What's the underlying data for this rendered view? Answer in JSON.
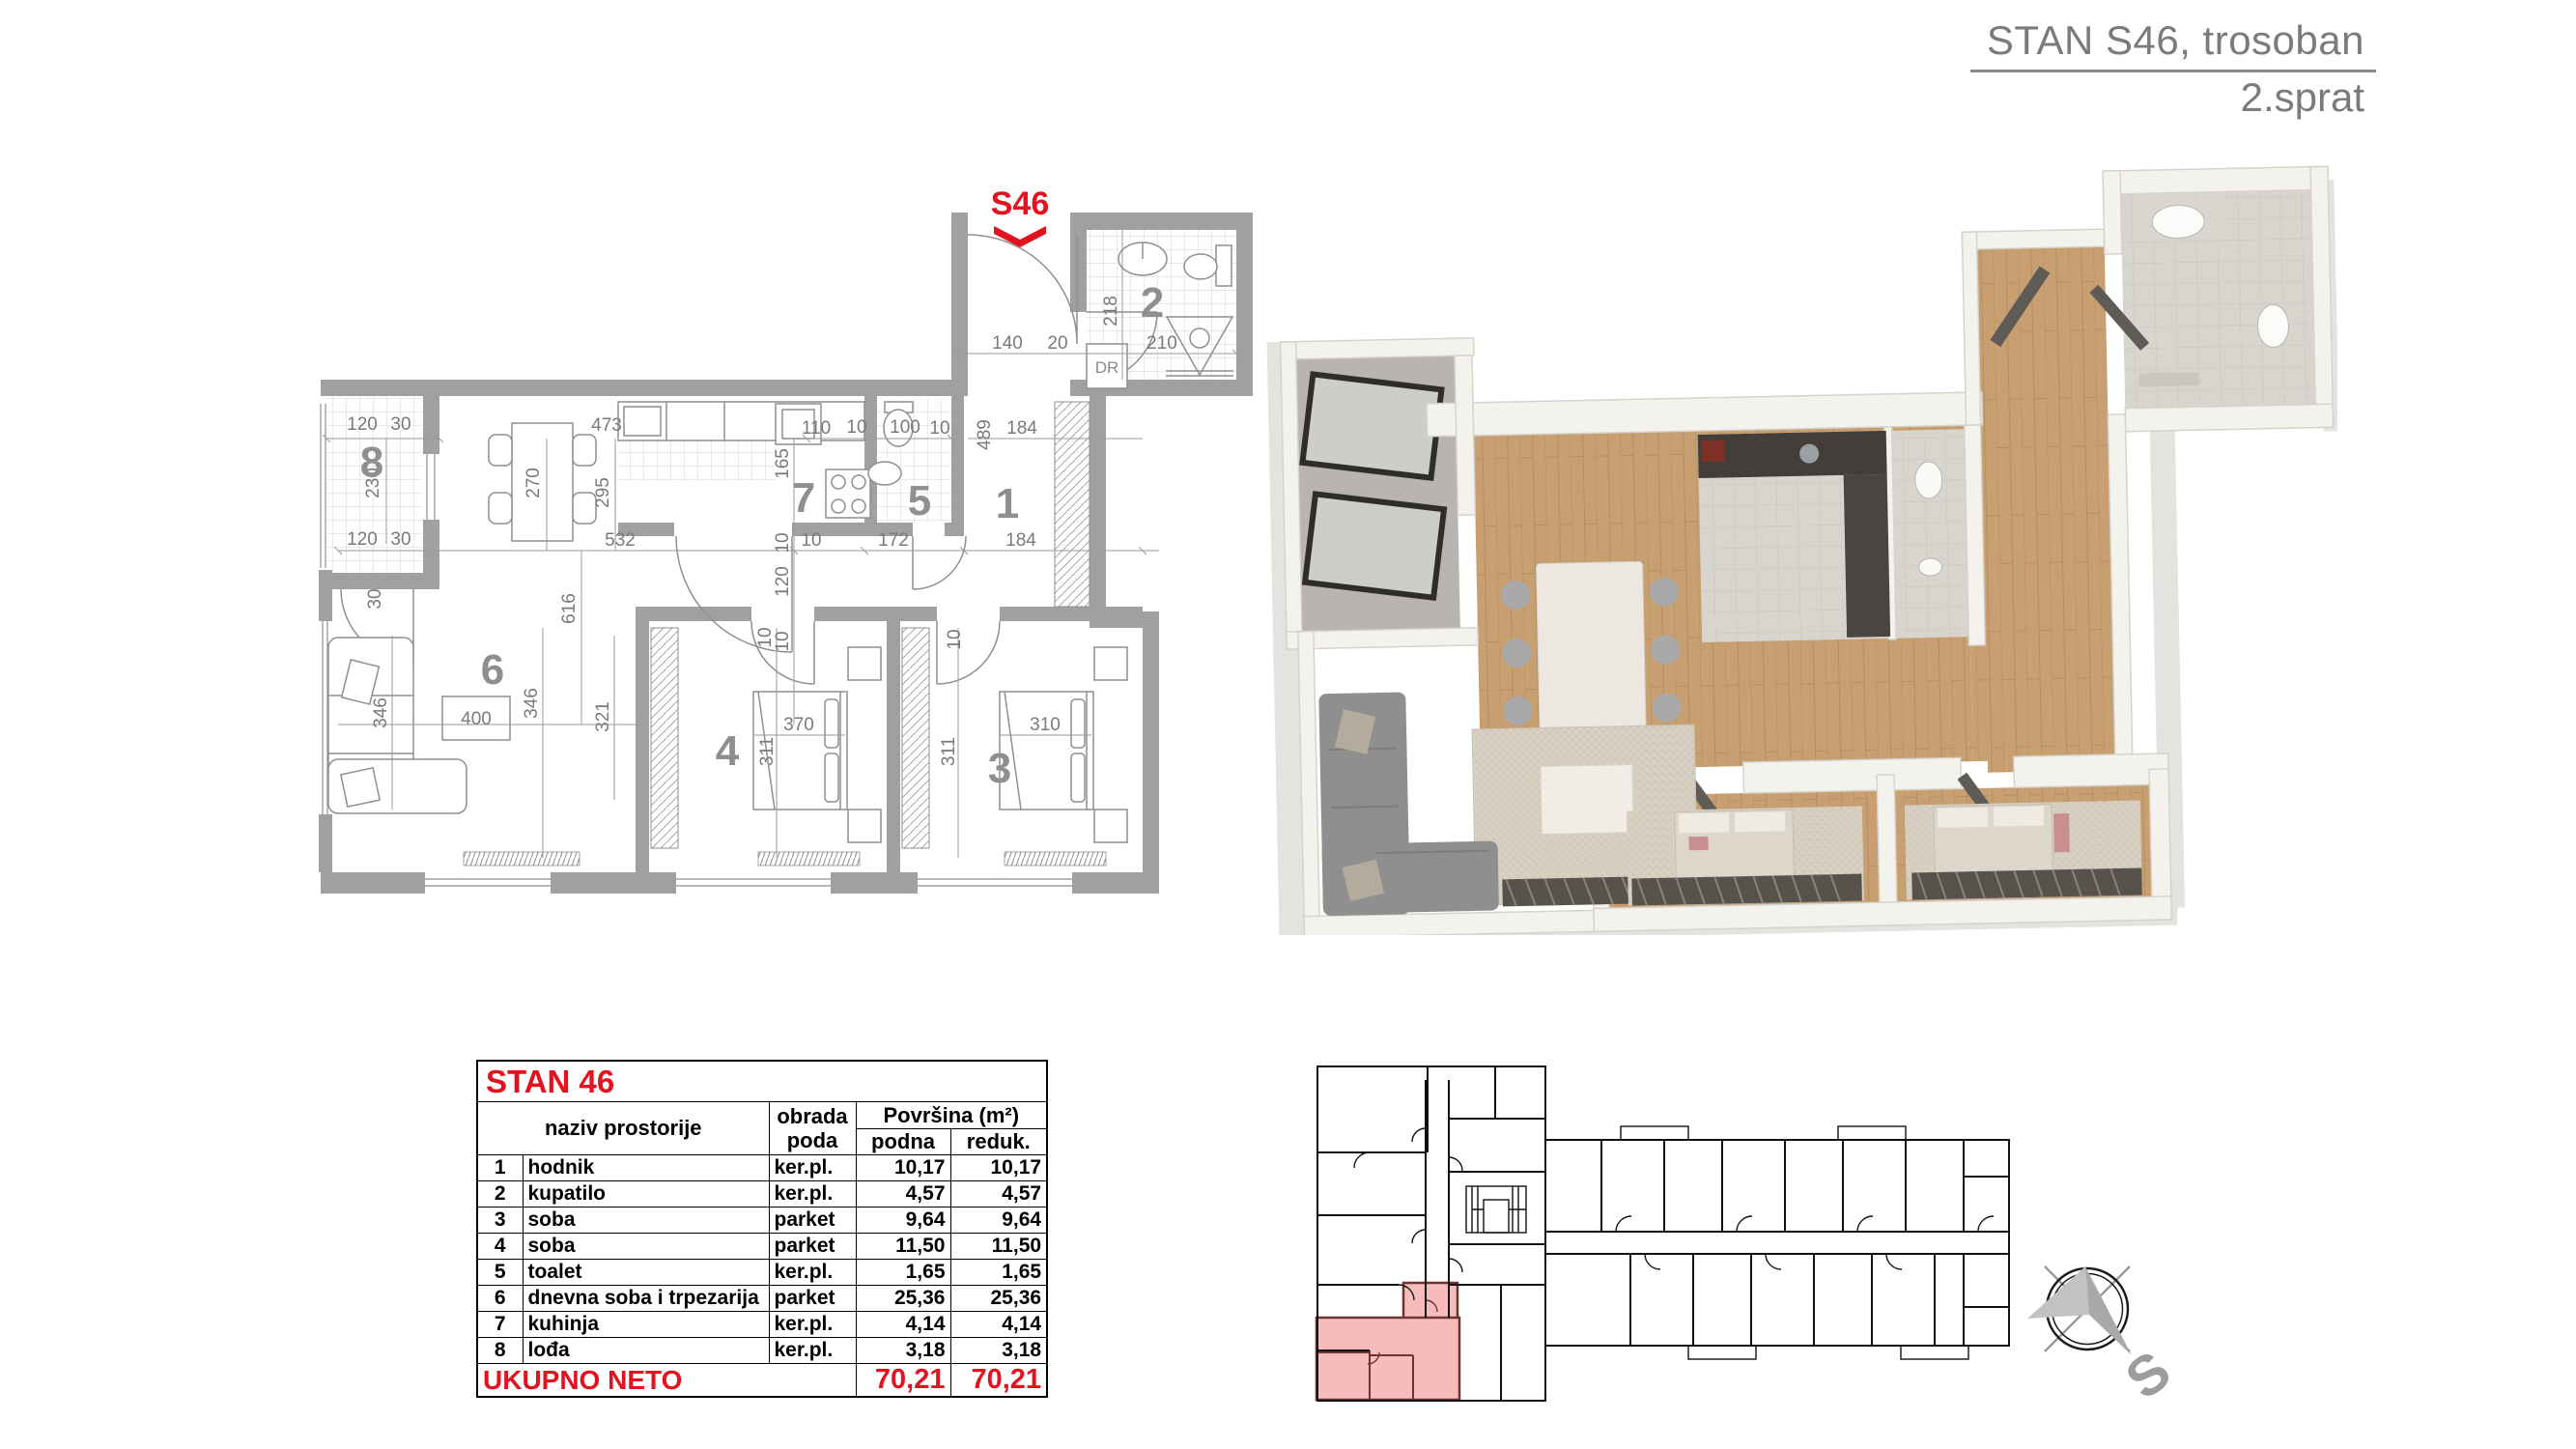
{
  "header": {
    "title": "STAN S46, trosoban",
    "floor": "2.sprat"
  },
  "plan2d": {
    "unit_label": "S46",
    "closet_label": "DR",
    "rooms": [
      "1",
      "2",
      "3",
      "4",
      "5",
      "6",
      "7",
      "8"
    ],
    "dims": [
      "120",
      "30",
      "230",
      "120",
      "30",
      "30",
      "473",
      "270",
      "295",
      "532",
      "616",
      "346",
      "346",
      "400",
      "321",
      "110",
      "10",
      "100",
      "10",
      "165",
      "10",
      "10",
      "172",
      "120",
      "10",
      "489",
      "184",
      "184",
      "140",
      "20",
      "218",
      "210",
      "370",
      "311",
      "310",
      "311",
      "10",
      "10"
    ]
  },
  "table": {
    "title": "STAN 46",
    "col_naziv": "naziv prostorije",
    "col_obrada_1": "obrada",
    "col_obrada_2": "poda",
    "col_povrsina": "Površina (m²)",
    "col_podna": "podna",
    "col_reduk": "reduk.",
    "rows": [
      {
        "num": "1",
        "name": "hodnik",
        "floor": "ker.pl.",
        "podna": "10,17",
        "reduk": "10,17"
      },
      {
        "num": "2",
        "name": "kupatilo",
        "floor": "ker.pl.",
        "podna": "4,57",
        "reduk": "4,57"
      },
      {
        "num": "3",
        "name": "soba",
        "floor": "parket",
        "podna": "9,64",
        "reduk": "9,64"
      },
      {
        "num": "4",
        "name": "soba",
        "floor": "parket",
        "podna": "11,50",
        "reduk": "11,50"
      },
      {
        "num": "5",
        "name": "toalet",
        "floor": "ker.pl.",
        "podna": "1,65",
        "reduk": "1,65"
      },
      {
        "num": "6",
        "name": "dnevna soba i trpezarija",
        "floor": "parket",
        "podna": "25,36",
        "reduk": "25,36"
      },
      {
        "num": "7",
        "name": "kuhinja",
        "floor": "ker.pl.",
        "podna": "4,14",
        "reduk": "4,14"
      },
      {
        "num": "8",
        "name": "lođa",
        "floor": "ker.pl.",
        "podna": "3,18",
        "reduk": "3,18"
      }
    ],
    "total_label": "UKUPNO NETO",
    "total_podna": "70,21",
    "total_reduk": "70,21"
  },
  "compass": {
    "south_label": "S"
  },
  "colors": {
    "accent_red": "#e4121e",
    "highlight_pink": "#f6bcbc",
    "highlight_wall": "#6e3434"
  }
}
